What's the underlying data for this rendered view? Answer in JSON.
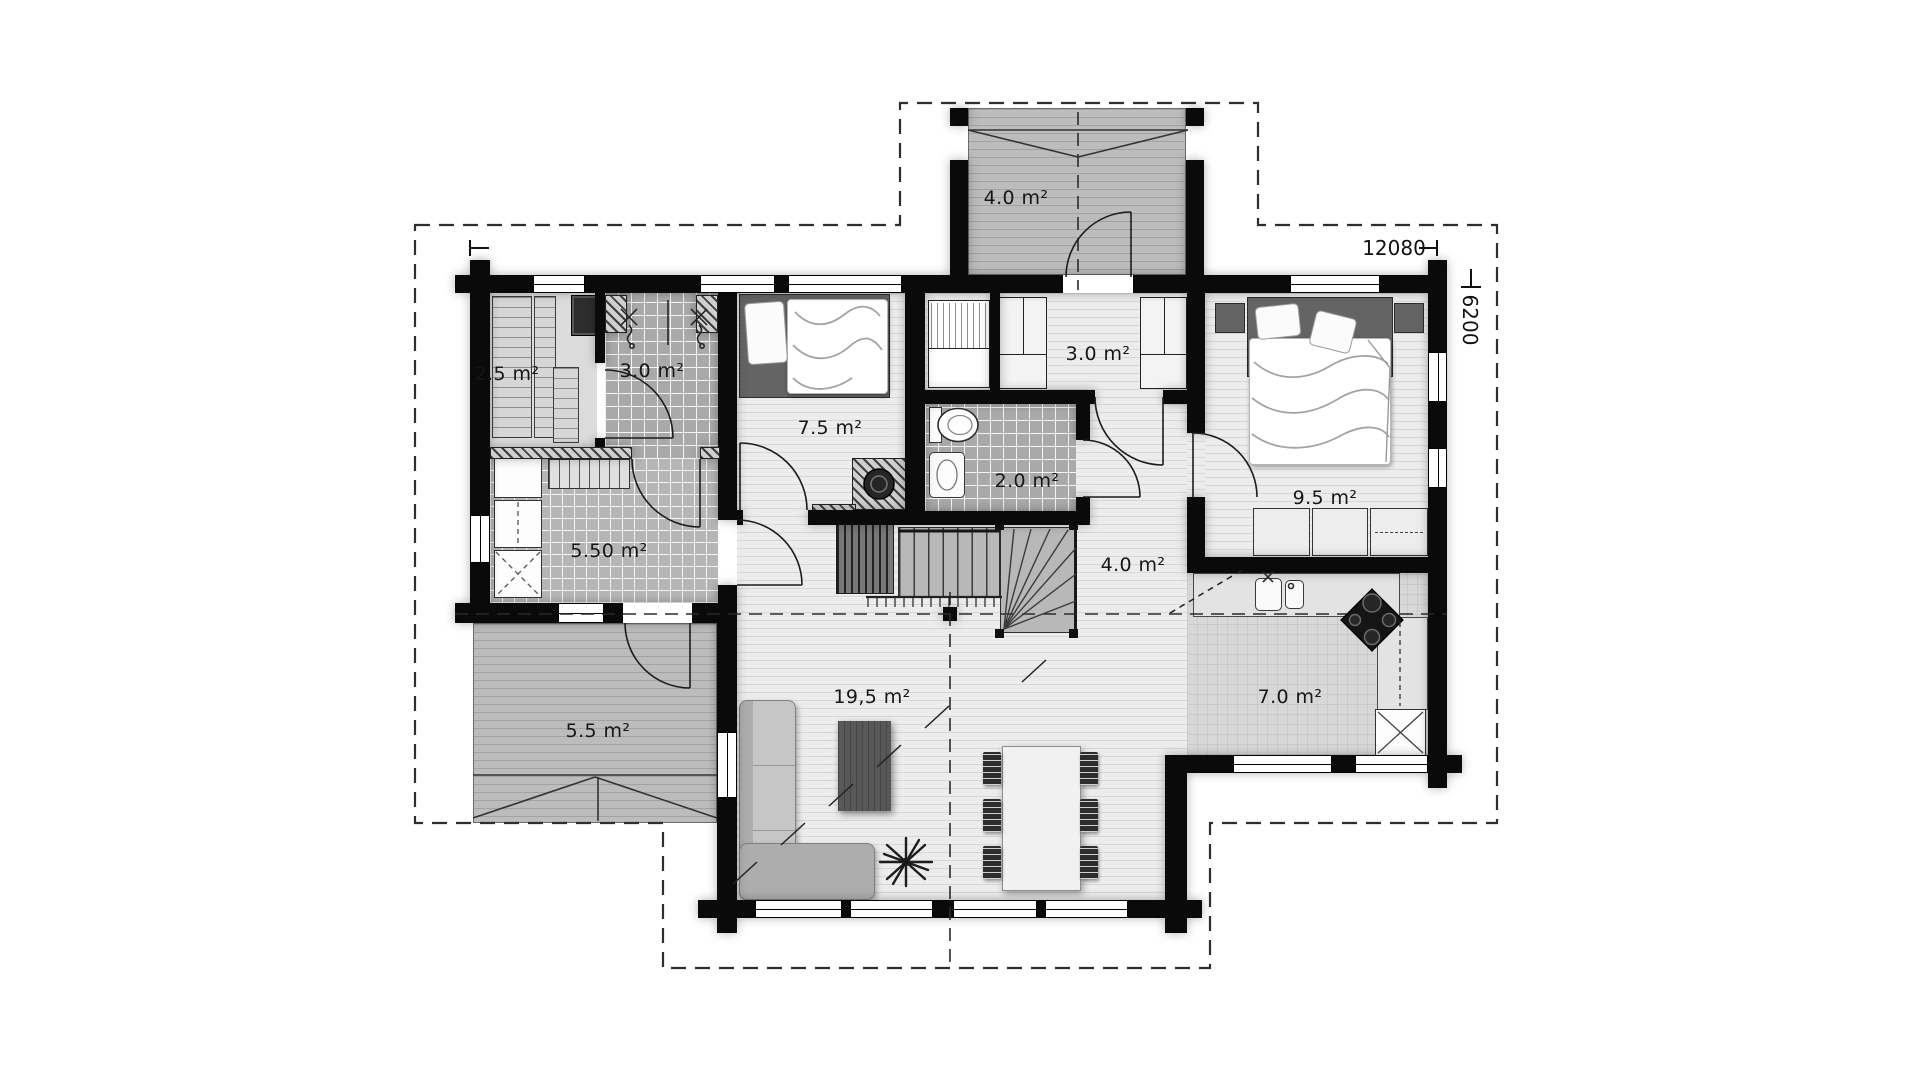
{
  "plan": {
    "dimensions": {
      "width_mm": "12080",
      "depth_mm": "6200"
    },
    "rooms": {
      "porch": "4.0 m²",
      "entry": "3.0 m²",
      "sauna": "2.5 m²",
      "shower": "3.0 m²",
      "bedroom_small": "7.5 m²",
      "wc": "2.0 m²",
      "utility": "5.50 m²",
      "hall": "4.0 m²",
      "bedroom_master": "9.5 m²",
      "terrace": "5.5 m²",
      "living_room": "19,5 m²",
      "kitchen": "7.0 m²"
    },
    "colors": {
      "wall": "#0a0a0a",
      "floor_wood": "#ececec",
      "floor_tile": "#a9a9a9",
      "deck": "#bcbcbc",
      "background": "#ffffff"
    }
  }
}
